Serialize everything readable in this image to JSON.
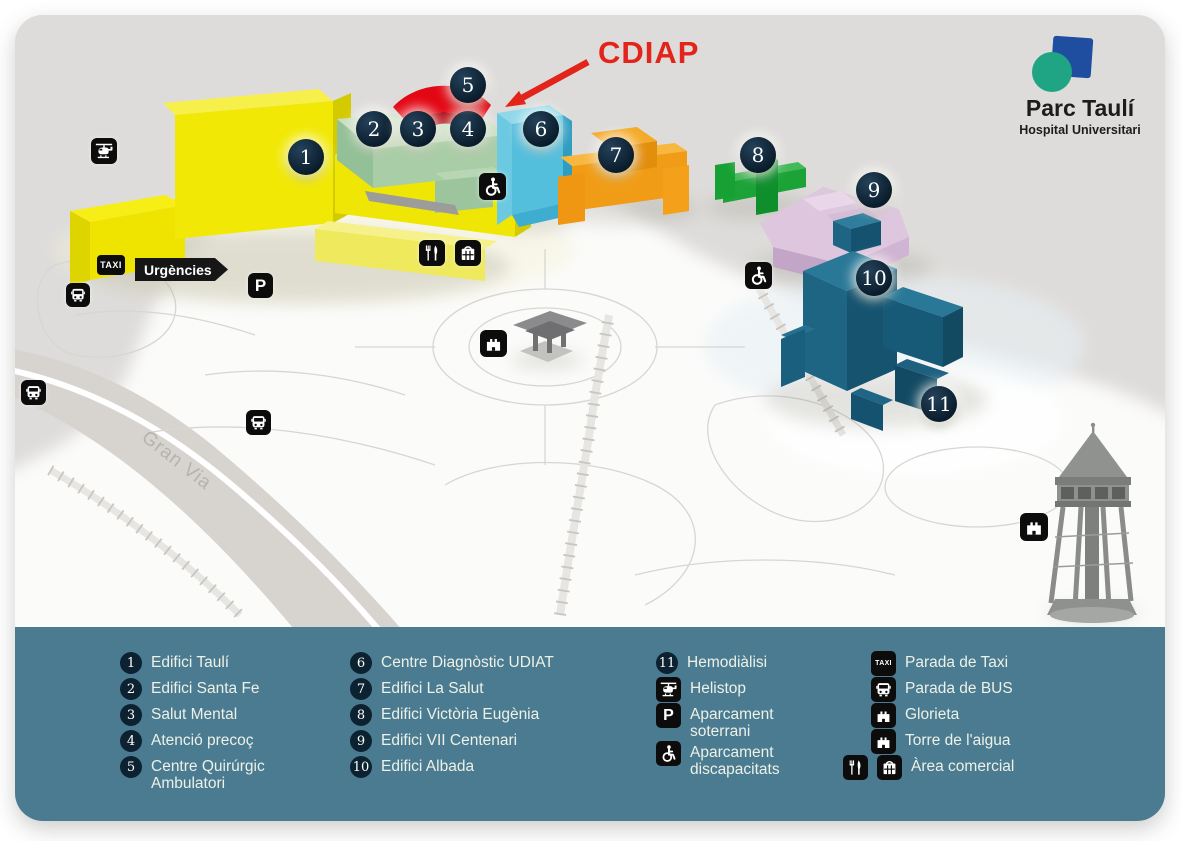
{
  "logo": {
    "title": "Parc Taulí",
    "subtitle": "Hospital Universitari"
  },
  "annotation": {
    "label": "CDIAP",
    "color": "#e2241b"
  },
  "map": {
    "labels": {
      "urgencies": "Urgències",
      "taxi": "TAXI",
      "gran_via": "Gran Via"
    }
  },
  "colors": {
    "legend_bg": "#4b7b91",
    "marker_bg": "#0d2231",
    "map_bg": "#dedcda",
    "campus_bg": "#fbfbfa",
    "road": "#d7d4d0",
    "logo_blue": "#1f4da0",
    "logo_green": "#1fa583"
  },
  "legend": {
    "parking_label": "P",
    "items": [
      {
        "num": "1",
        "label": "Edifici Taulí",
        "color": "#f1e805"
      },
      {
        "num": "2",
        "label": "Edifici Santa Fe",
        "color": "#a9cda6"
      },
      {
        "num": "3",
        "label": "Salut Mental",
        "color": "#a9cda6"
      },
      {
        "num": "4",
        "label": "Atenció precoç",
        "color": "#a9cda6"
      },
      {
        "num": "5",
        "label": "Centre Quirúrgic Ambulatori",
        "color": "#e30613"
      },
      {
        "num": "6",
        "label": "Centre Diagnòstic UDIAT",
        "color": "#54bedd"
      },
      {
        "num": "7",
        "label": "Edifici La Salut",
        "color": "#f09c17"
      },
      {
        "num": "8",
        "label": "Edifici Victòria Eugènia",
        "color": "#1ba338"
      },
      {
        "num": "9",
        "label": "Edifici VII Centenari",
        "color": "#ddc6de"
      },
      {
        "num": "10",
        "label": "Edifici Albada",
        "color": "#1d6583"
      },
      {
        "num": "11",
        "label": "Hemodiàlisi",
        "color": "#1d6583"
      }
    ],
    "facilities": [
      {
        "icon": "helicopter-icon",
        "label": "Helistop"
      },
      {
        "icon": "parking-icon",
        "label": "Aparcament soterrani"
      },
      {
        "icon": "wheelchair-icon",
        "label": "Aparcament discapacitats"
      },
      {
        "icon": "taxi-icon",
        "label": "Parada de Taxi"
      },
      {
        "icon": "bus-icon",
        "label": "Parada de BUS"
      },
      {
        "icon": "tower-icon",
        "label": "Glorieta"
      },
      {
        "icon": "tower-icon",
        "label": "Torre de l'aigua"
      },
      {
        "icon": "restaurant-icon, shop-icon",
        "label": "Àrea comercial"
      }
    ]
  }
}
